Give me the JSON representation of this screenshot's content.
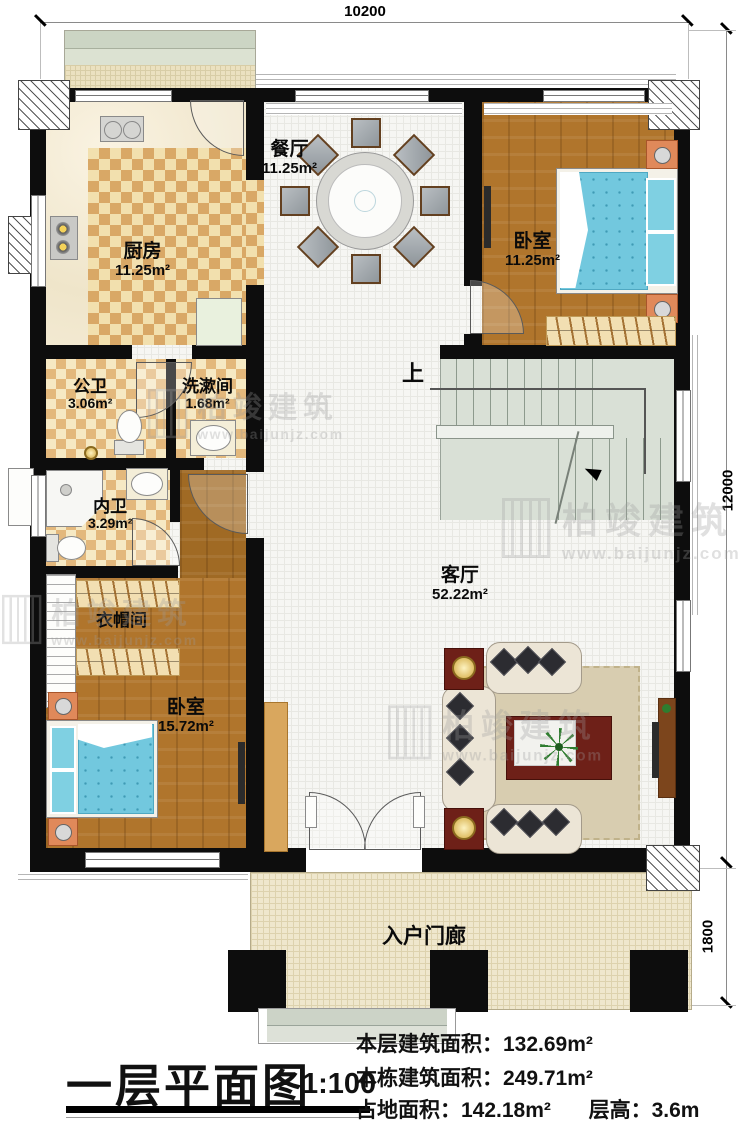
{
  "plan": {
    "rooms": {
      "dining": {
        "name": "餐厅",
        "area": "11.25m²"
      },
      "kitchen": {
        "name": "厨房",
        "area": "11.25m²"
      },
      "bedroom_top": {
        "name": "卧室",
        "area": "11.25m²"
      },
      "public_bath": {
        "name": "公卫",
        "area": "3.06m²"
      },
      "washroom": {
        "name": "洗漱间",
        "area": "1.68m²"
      },
      "private_bath": {
        "name": "内卫",
        "area": "3.29m²"
      },
      "cloakroom": {
        "name": "衣帽间"
      },
      "bedroom_main": {
        "name": "卧室",
        "area": "15.72m²"
      },
      "living": {
        "name": "客厅",
        "area": "52.22m²"
      },
      "porch": {
        "name": "入户门廊"
      }
    },
    "stairs": {
      "up_label": "上"
    },
    "dimensions": {
      "top_width": "10200",
      "right_height": "12000",
      "porch_depth": "1800"
    }
  },
  "watermark": {
    "brand": "柏竣建筑",
    "url": "www.baijunjz.com"
  },
  "title_block": {
    "title": "一层平面图",
    "scale": "1:100",
    "stats": [
      {
        "label": "本层建筑面积：",
        "value": "132.69m²"
      },
      {
        "label": "本栋建筑面积：",
        "value": "249.71m²"
      },
      {
        "label": "占地面积：",
        "value": "142.18m²"
      },
      {
        "label": "层高：",
        "value": "3.6m"
      }
    ]
  }
}
